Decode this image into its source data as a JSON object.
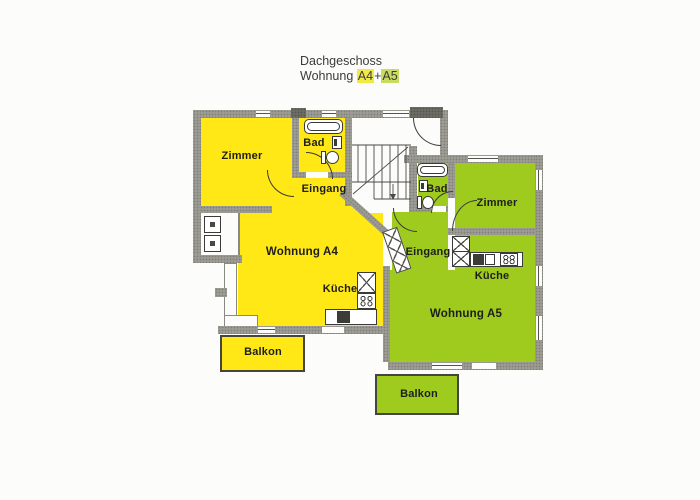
{
  "title": {
    "line1": "Dachgeschoss",
    "line2_prefix": "Wohnung",
    "unit_a4": "A4",
    "plus": "+",
    "unit_a5": "A5"
  },
  "colors": {
    "a4_fill": "#ffe815",
    "a5_fill": "#9fca1e",
    "a4_highlight": "#f1ea45",
    "a5_highlight": "#c9dc5f",
    "wall": "#9c9c95",
    "wall_dark": "#6c6c64",
    "line": "#3a3a38",
    "background": "#fcfcfa"
  },
  "a4": {
    "name": "Wohnung A4",
    "zimmer": "Zimmer",
    "bad": "Bad",
    "eingang": "Eingang",
    "wohnen": "Wohnung A4",
    "kueche": "Küche",
    "balkon": "Balkon"
  },
  "a5": {
    "name": "Wohnung A5",
    "zimmer": "Zimmer",
    "bad": "Bad",
    "eingang": "Eingang",
    "wohnen": "Wohnung A5",
    "kueche": "Küche",
    "balkon": "Balkon"
  },
  "fixtures": [
    "bathtub-icon",
    "toilet-icon",
    "washbasin-icon",
    "stove-icon",
    "kitchen-sink-icon",
    "cupboard-icon",
    "staircase-icon",
    "door-swing-icon",
    "window-icon",
    "built-in-unit-icon"
  ]
}
